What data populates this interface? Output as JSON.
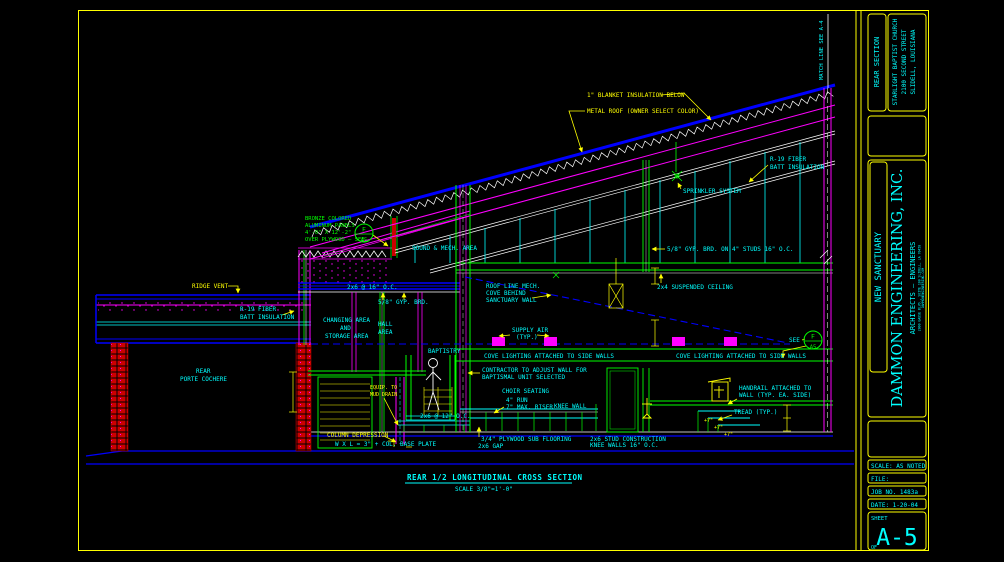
{
  "sheet": {
    "colors": {
      "background": "#000000",
      "border": "#ffff00",
      "annotation_cyan": "#00ffff",
      "annotation_yellow": "#ffff00",
      "line_blue": "#0000ff",
      "line_green": "#00ff00",
      "line_magenta": "#ff00ff",
      "line_red": "#dd0000",
      "line_white": "#ffffff"
    },
    "title_block": {
      "section": "REAR SECTION",
      "church": [
        "STARLIGHT BAPTIST CHURCH",
        "2100 SECOND STREET",
        "SLIDELL, LOUISIANA"
      ],
      "project": "NEW SANCTUARY",
      "firm": "DAMMON ENGINEERING, INC.",
      "firm_sub": "ARCHITECTS — ENGINEERS",
      "firm_addr1": "2000 GAUSE BLVD., SUITE 100   SLIDELL, LA 70458",
      "firm_addr2": "DAMMONENGINEERING.COM",
      "scale": "SCALE: AS NOTED",
      "file": "FILE:",
      "job": "JOB NO. 1483a",
      "date": "DATE: 1-20-04",
      "sheet_label": "SHEET",
      "sheet_no": "A-5",
      "of": "OF"
    },
    "drawing_title": {
      "text": "REAR 1/2 LONGITUDINAL CROSS SECTION",
      "scale": "SCALE 3/8\"=1'-0\""
    },
    "callout": {
      "top": "F",
      "bottom": "A5"
    },
    "labels": {
      "ridge_vent": "RIDGE VENT",
      "r19_left": [
        "R-19 FIBER",
        "BATT INSULATION"
      ],
      "porte_cochere": [
        "REAR",
        "PORTE COCHERE"
      ],
      "blanket": "1\" BLANKET INSULATION BELOW",
      "metal_roof": "METAL ROOF (OWNER SELECT COLOR)",
      "r19_right": [
        "R-19 FIBER",
        "BATT INSULATION"
      ],
      "sprinkler": "SPRINKLER SYSTEM",
      "panels": [
        "BRONZE COLORED",
        "ALUMINUM PANELS",
        "4'-0\" X 12'-2\"",
        "OVER PLYWOOD — SEE"
      ],
      "sound_mech": "SOUND & MECH. AREA",
      "gyp_studs": "5/8\" GYP. BRD. ON 4\" STUDS 16\" O.C.",
      "susp_ceiling": "2x4 SUSPENDED CEILING",
      "roof_line": [
        "ROOF LINE MECH.",
        "COVE BEHIND",
        "SANCTUARY WALL"
      ],
      "supply_air": [
        "SUPPLY AIR",
        "(TYP.)"
      ],
      "cove_left": "COVE LIGHTING ATTACHED TO SIDE WALLS",
      "cove_right": "COVE LIGHTING ATTACHED TO SIDE WALLS",
      "contractor": [
        "CONTRACTOR TO ADJUST WALL FOR",
        "BAPTISMAL UNIT SELECTED"
      ],
      "choir": "CHOIR SEATING",
      "run_riser": [
        "4\" RUN",
        "7\" MAX. RISER"
      ],
      "knee_wall": "KNEE WALL",
      "handrail": [
        "HANDRAIL ATTACHED TO",
        "WALL (TYP. EA. SIDE)"
      ],
      "tread": "TREAD (TYP.)",
      "stud_knee": [
        "2x6 STUD CONSTRUCTION",
        "KNEE WALLS 16\" O.C."
      ],
      "plywood": "3/4\" PLYWOOD SUB FLOORING",
      "gap": "2x6 GAP",
      "beam_2x6": "2x6 @ 16\" O.C.",
      "gyp_small": "5/8\" GYP. BRD.",
      "changing": [
        "CHANGING AREA",
        "AND",
        "STORAGE AREA"
      ],
      "hall": [
        "HALL",
        "AREA"
      ],
      "baptistry": "BAPTISTRY",
      "equip_drain": [
        "EQUIP. TO",
        "MUD DRAIN"
      ],
      "col_depression": "COLUMN DEPRESSION",
      "base_plate": "W X L = 3\" + COL. BASE PLATE",
      "platform_2x6": "2x6 @ 12\" O.C.",
      "plus7": "+7\"",
      "see": "SEE",
      "match_line": "MATCH LINE SEE A-4"
    }
  }
}
